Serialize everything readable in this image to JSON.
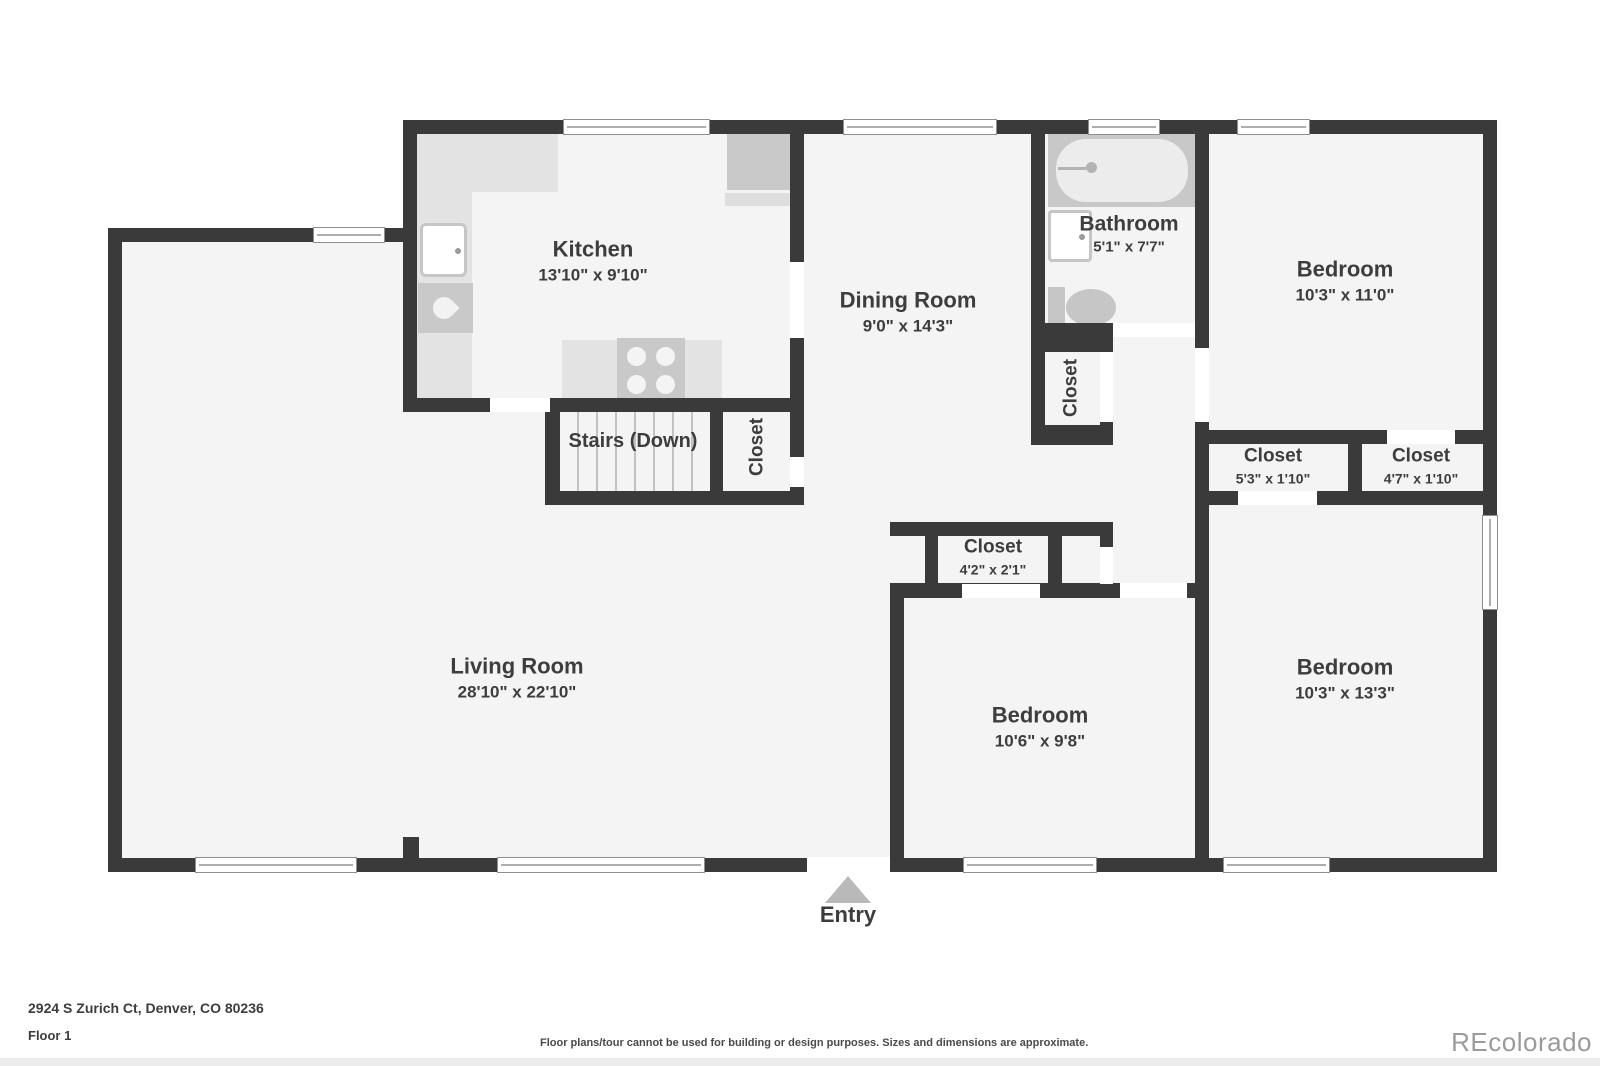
{
  "page": {
    "address": "2924 S Zurich Ct, Denver, CO 80236",
    "floor_label": "Floor 1",
    "disclaimer": "Floor plans/tour cannot be used for building or design purposes. Sizes and dimensions are approximate.",
    "watermark": "REcolorado"
  },
  "entry": {
    "label": "Entry"
  },
  "rooms": {
    "kitchen": {
      "name": "Kitchen",
      "dims": "13'10\" x 9'10\""
    },
    "dining_room": {
      "name": "Dining Room",
      "dims": "9'0\" x 14'3\""
    },
    "bathroom": {
      "name": "Bathroom",
      "dims": "5'1\" x 7'7\""
    },
    "bedroom_top_right": {
      "name": "Bedroom",
      "dims": "10'3\" x 11'0\""
    },
    "bedroom_bottom_right": {
      "name": "Bedroom",
      "dims": "10'3\" x 13'3\""
    },
    "bedroom_middle": {
      "name": "Bedroom",
      "dims": "10'6\" x 9'8\""
    },
    "living_room": {
      "name": "Living Room",
      "dims": "28'10\" x 22'10\""
    },
    "stairs": {
      "name": "Stairs (Down)"
    },
    "closet_hall": {
      "name": "Closet"
    },
    "closet_stairs": {
      "name": "Closet"
    },
    "closet_53": {
      "name": "Closet",
      "dims": "5'3\" x 1'10\""
    },
    "closet_47": {
      "name": "Closet",
      "dims": "4'7\" x 1'10\""
    },
    "closet_42": {
      "name": "Closet",
      "dims": "4'2\" x 2'1\""
    }
  },
  "icons": [
    "entry-arrow",
    "bathtub",
    "toilet",
    "bathroom-sink",
    "kitchen-sink",
    "stove",
    "dishwasher",
    "refrigerator",
    "window",
    "door-opening"
  ],
  "colors": {
    "wall": "#3a3a3a",
    "floor": "#f4f4f4",
    "counter": "#e3e3e3",
    "appliance": "#c9c9c9",
    "entry_arrow": "#b9b9b9",
    "watermark": "#9b9b9b",
    "label_text": "#3d3d3d"
  }
}
